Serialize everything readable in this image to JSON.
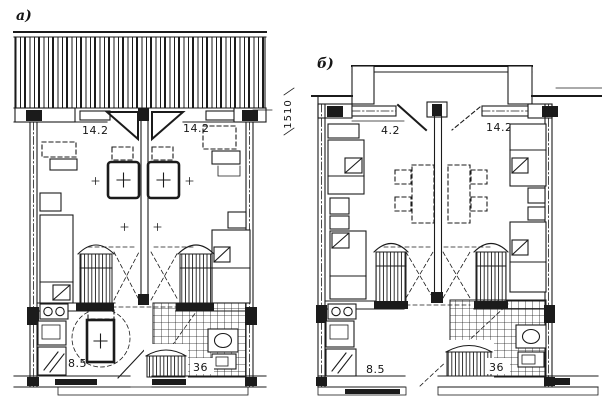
{
  "figure": {
    "ink_color": "#1b1b1b",
    "paper_color": "#ffffff",
    "panels": {
      "a": {
        "label": "а)",
        "room_left_area": "14.2",
        "room_right_area": "14.2",
        "kitchen_area": "8.5",
        "bath_area": "36"
      },
      "b": {
        "label": "б)",
        "room_left_area": "4.2",
        "room_right_area": "14.2",
        "kitchen_area": "8.5",
        "bath_area": "36"
      }
    },
    "dimension_label": "1510"
  }
}
